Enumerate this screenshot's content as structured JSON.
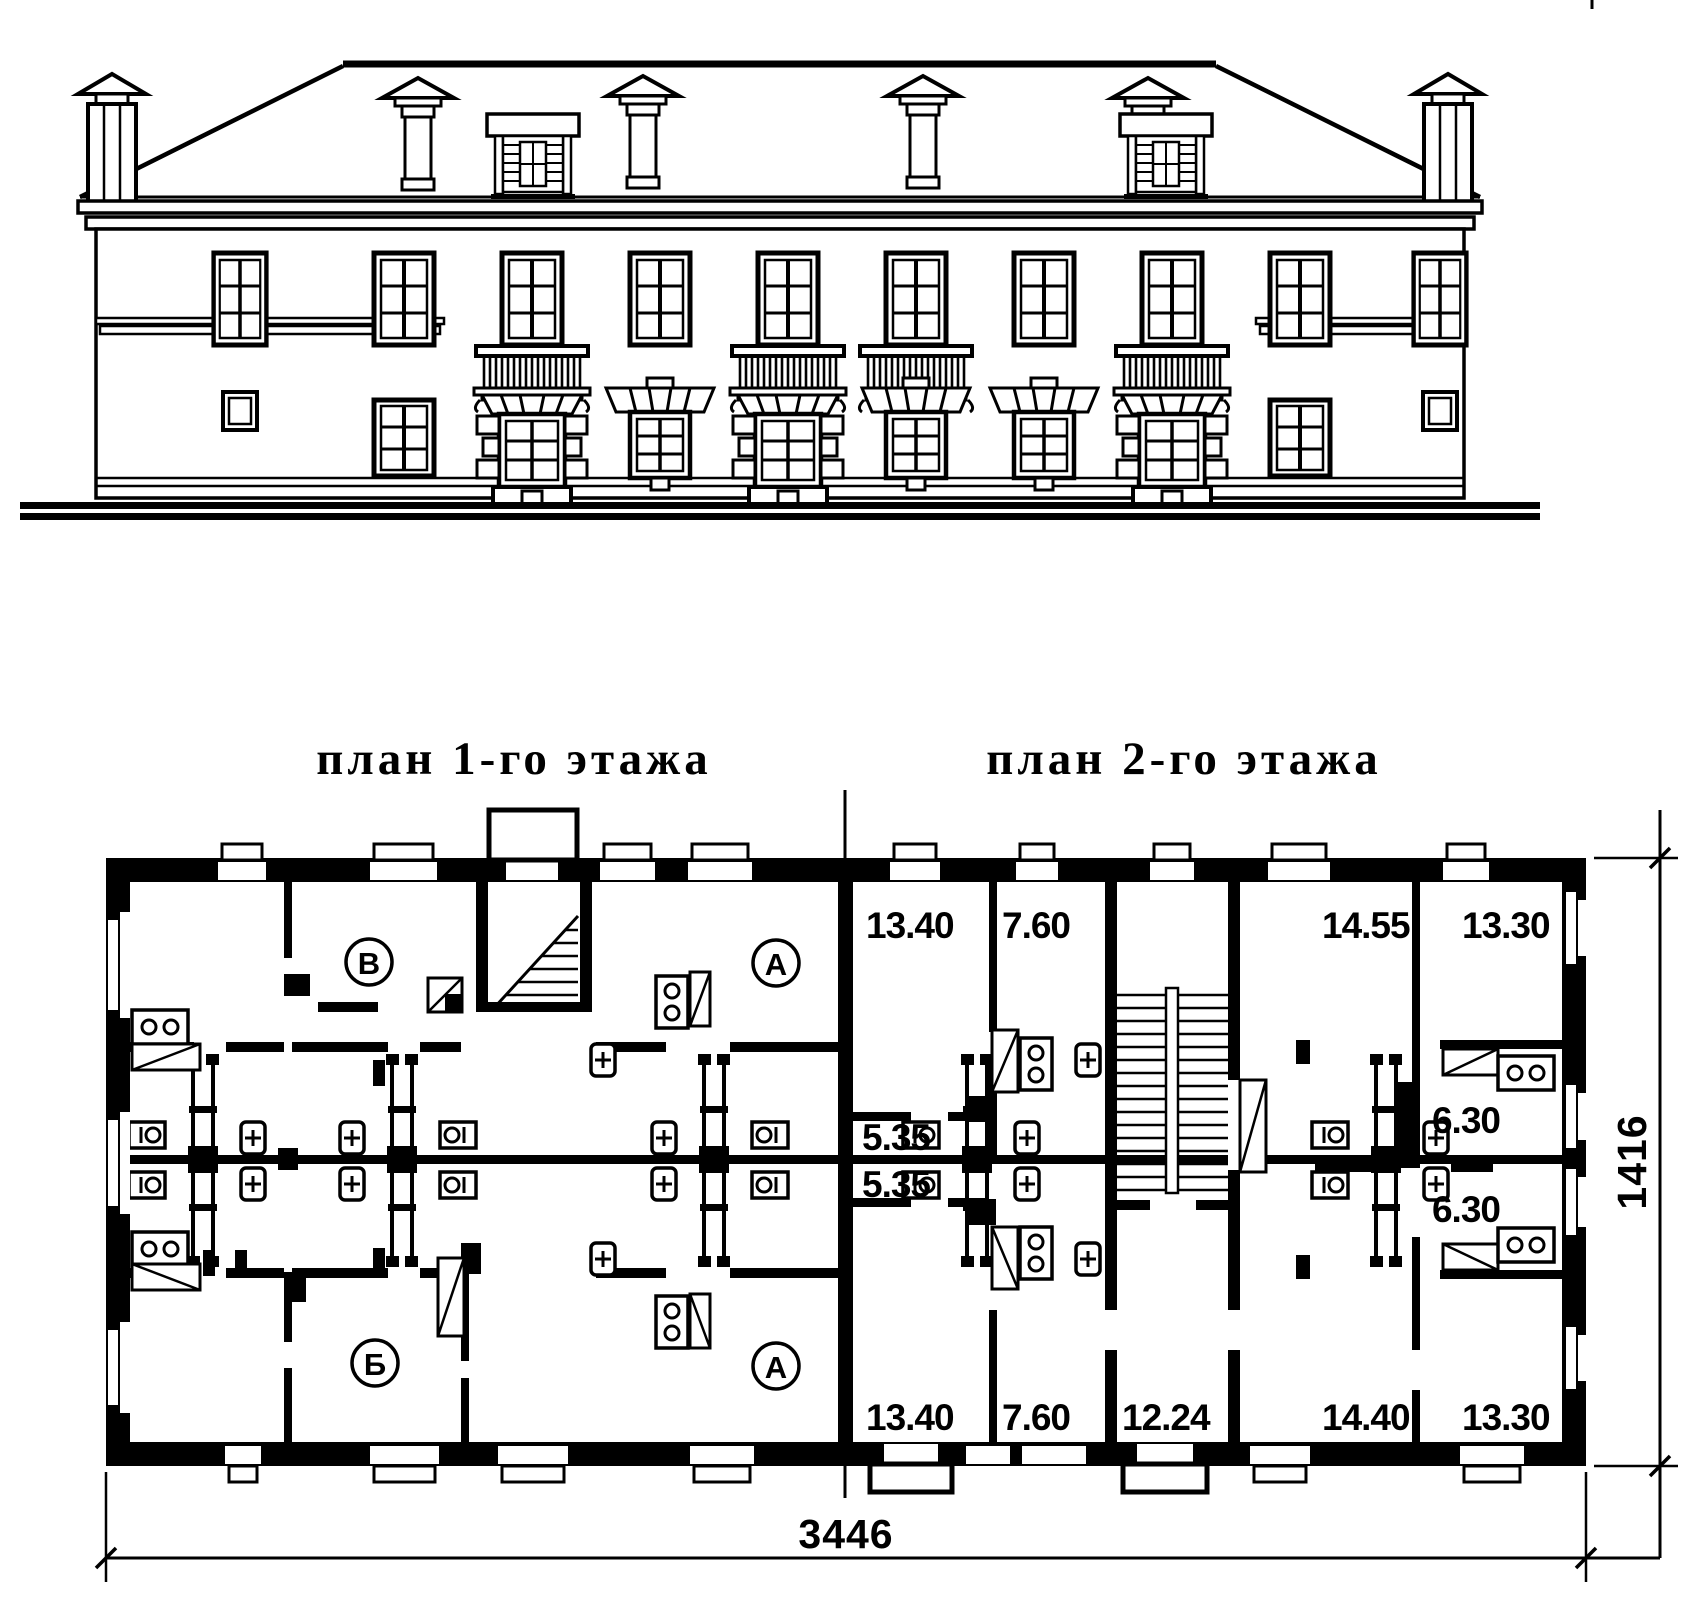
{
  "titles": {
    "floor1": "план 1-го этажа",
    "floor2": "план 2-го этажа"
  },
  "rooms": {
    "top_left": "В",
    "bottom_left": "Б",
    "top_right": "А",
    "bottom_right": "А"
  },
  "areas_floor2": {
    "top": [
      "13.40",
      "7.60",
      "14.55",
      "13.30"
    ],
    "hall": [
      "5.35",
      "5.35"
    ],
    "kitchens_right": [
      "6.30",
      "6.30"
    ],
    "bottom": [
      "13.40",
      "7.60",
      "12.24",
      "14.40",
      "13.30"
    ]
  },
  "dimensions": {
    "overall_width": "3446",
    "overall_height": "1416"
  },
  "colors": {
    "ink": "#000000",
    "paper": "#ffffff"
  }
}
